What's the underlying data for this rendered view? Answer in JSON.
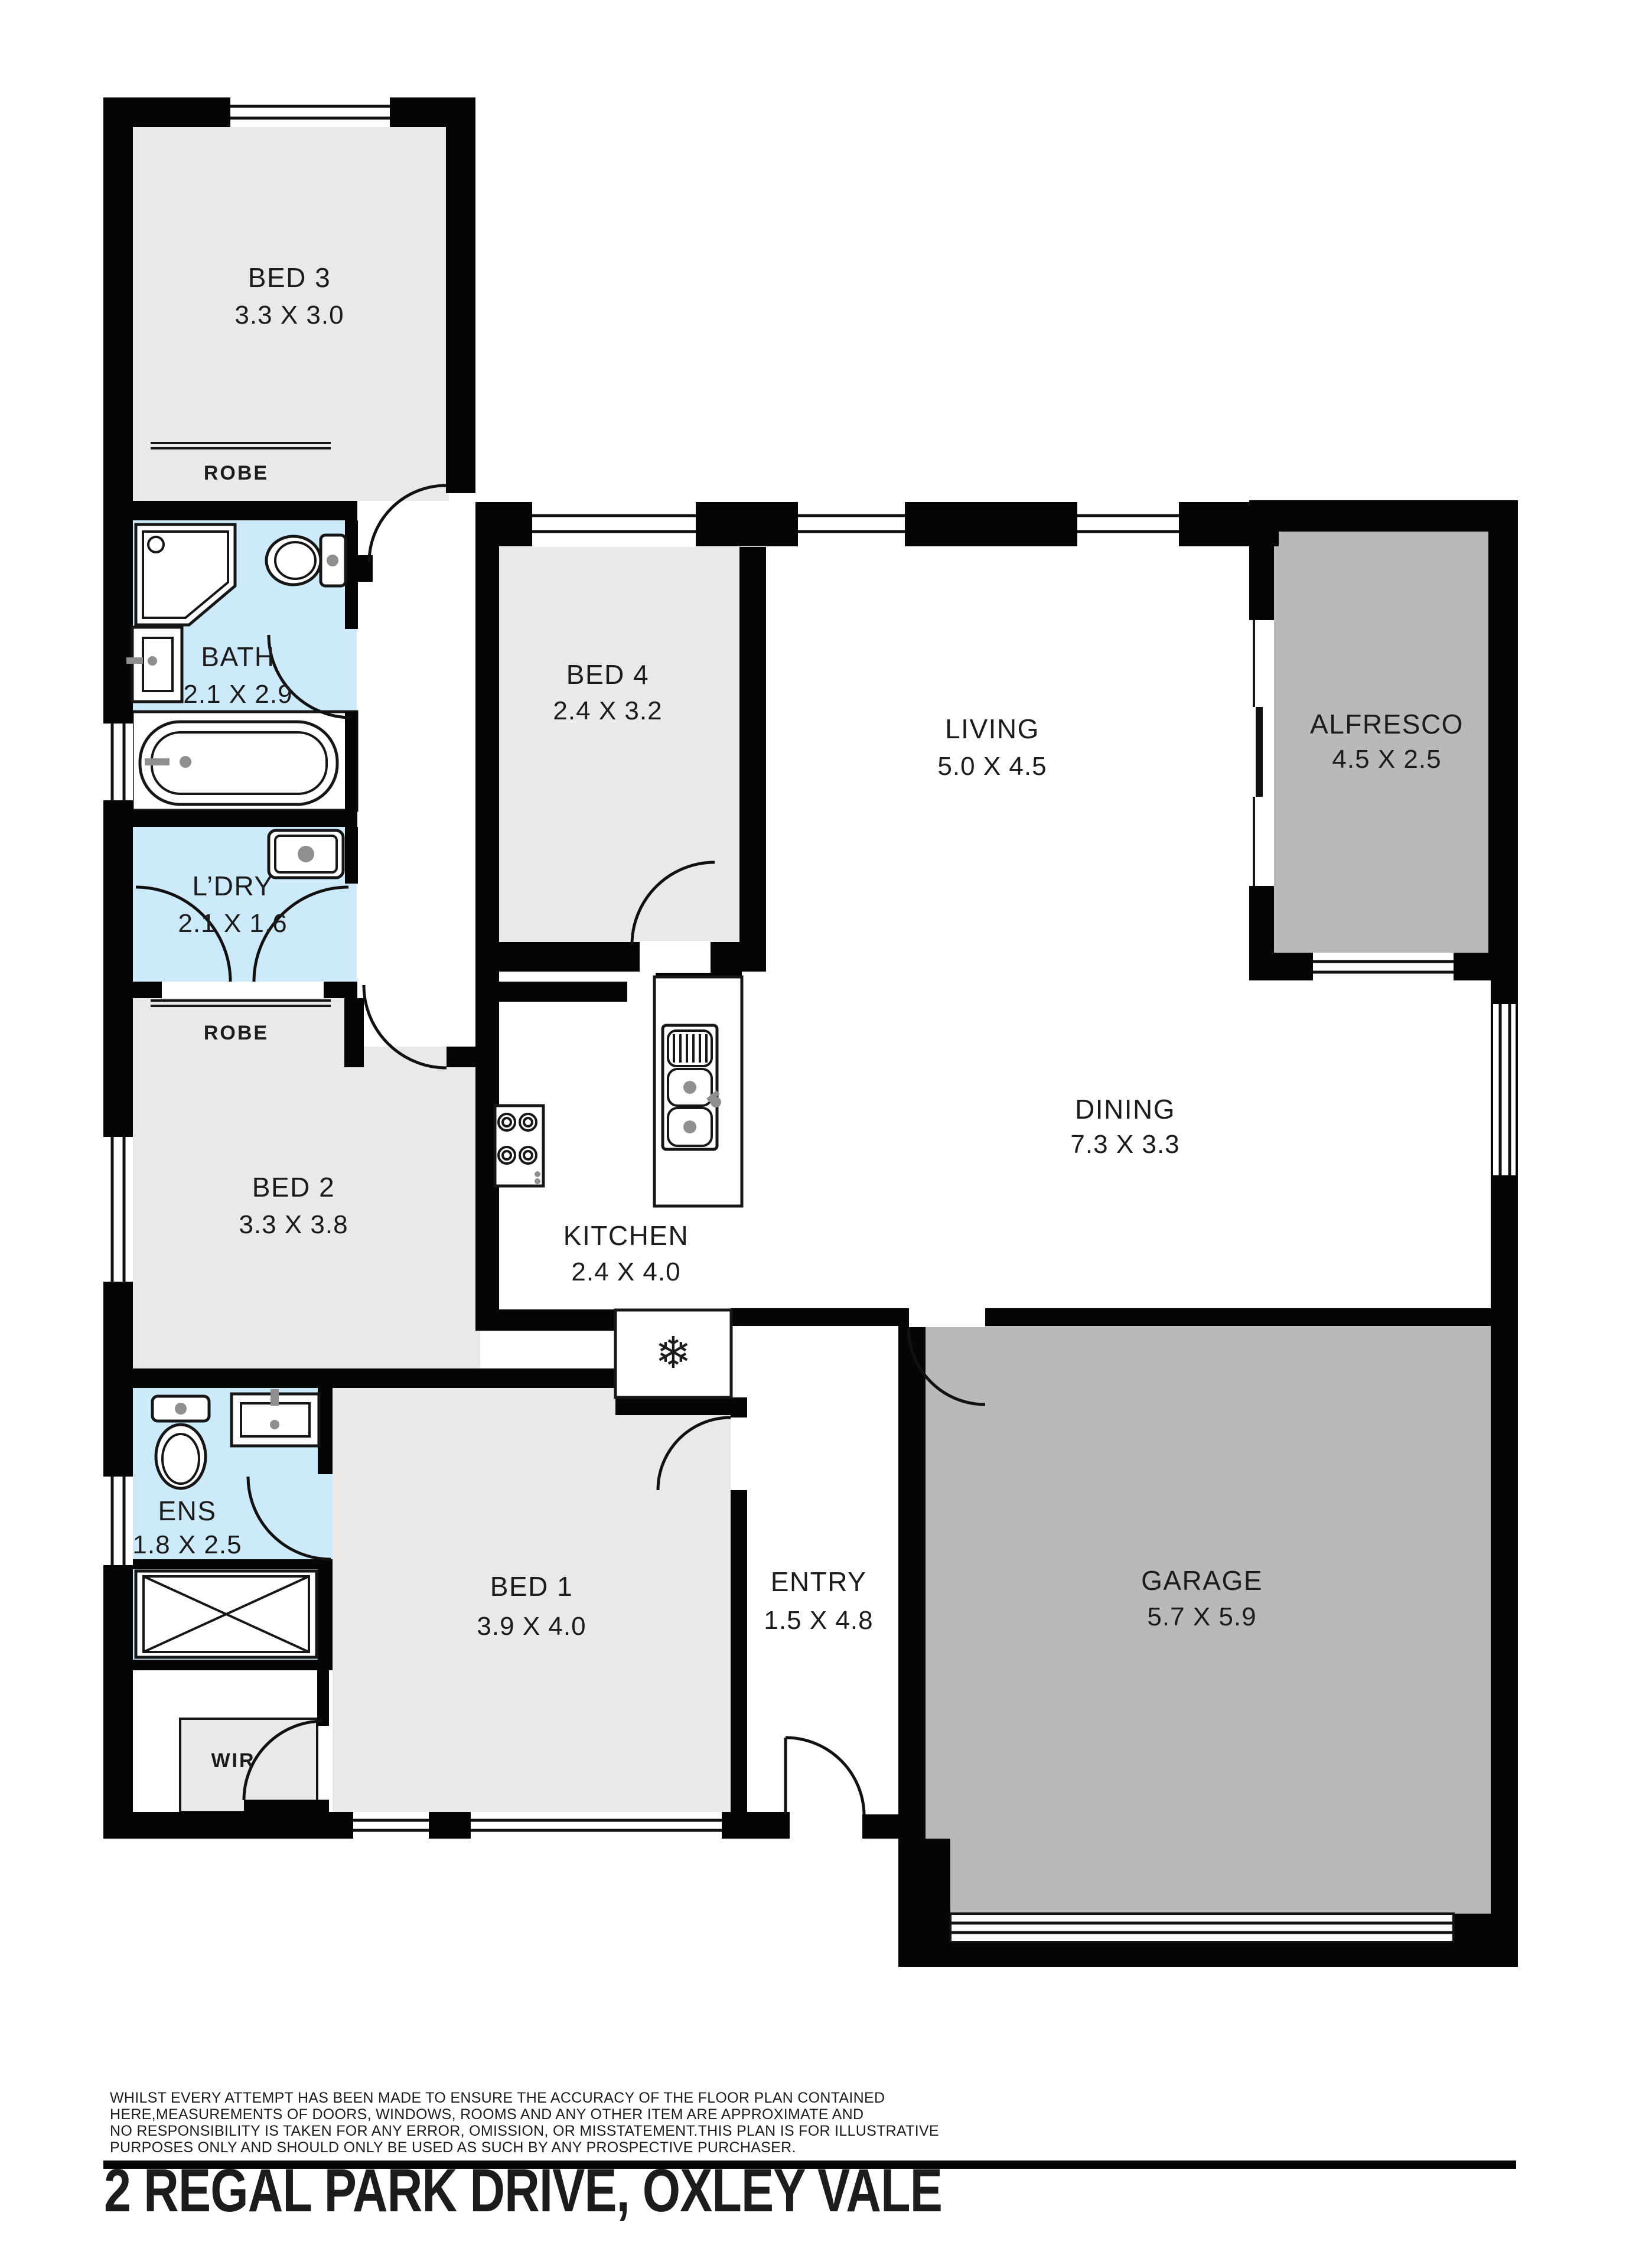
{
  "address": "2 REGAL PARK DRIVE, OXLEY VALE",
  "disclaimer_lines": [
    "WHILST EVERY ATTEMPT HAS BEEN MADE TO ENSURE THE ACCURACY OF THE FLOOR PLAN CONTAINED",
    "HERE,MEASUREMENTS OF DOORS, WINDOWS, ROOMS AND ANY OTHER ITEM ARE APPROXIMATE AND",
    "NO RESPONSIBILITY IS TAKEN FOR ANY ERROR, OMISSION, OR MISSTATEMENT.THIS PLAN IS FOR ILLUSTRATIVE",
    "PURPOSES ONLY AND SHOULD ONLY BE USED AS SUCH BY ANY PROSPECTIVE PURCHASER."
  ],
  "rooms": {
    "bed3": {
      "name": "BED 3",
      "dims": "3.3 X 3.0"
    },
    "robe1": {
      "name": "ROBE"
    },
    "bath": {
      "name": "BATH",
      "dims": "2.1 X 2.9"
    },
    "ldry": {
      "name": "L’DRY",
      "dims": "2.1 X 1.6"
    },
    "robe2": {
      "name": "ROBE"
    },
    "bed2": {
      "name": "BED 2",
      "dims": "3.3 X 3.8"
    },
    "bed4": {
      "name": "BED 4",
      "dims": "2.4 X 3.2"
    },
    "living": {
      "name": "LIVING",
      "dims": "5.0 X 4.5"
    },
    "alfresco": {
      "name": "ALFRESCO",
      "dims": "4.5 X 2.5"
    },
    "dining": {
      "name": "DINING",
      "dims": "7.3 X 3.3"
    },
    "kitchen": {
      "name": "KITCHEN",
      "dims": "2.4 X 4.0"
    },
    "ens": {
      "name": "ENS",
      "dims": "1.8 X 2.5"
    },
    "wir": {
      "name": "WIR"
    },
    "bed1": {
      "name": "BED 1",
      "dims": "3.9 X 4.0"
    },
    "entry": {
      "name": "ENTRY",
      "dims": "1.5 X 4.8"
    },
    "garage": {
      "name": "GARAGE",
      "dims": "5.7 X 5.9"
    }
  },
  "icons": {
    "fridge": "❄"
  },
  "colors": {
    "wall": "#050505",
    "bedroom_floor": "#e9e9e9",
    "wet_area_floor": "#cdeafa",
    "outdoor_floor": "#b9b9b9",
    "text": "#1c1c1c"
  }
}
